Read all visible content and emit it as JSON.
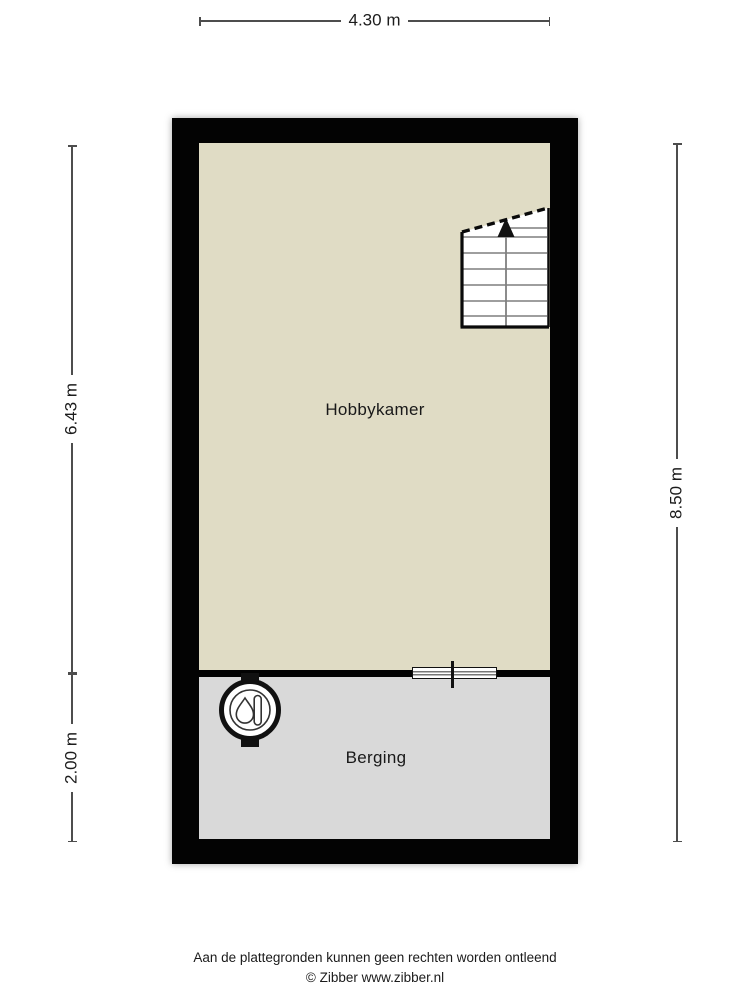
{
  "plan": {
    "dimensions": {
      "width_top": "4.30 m",
      "height_left_upper": "6.43 m",
      "height_left_lower": "2.00 m",
      "height_right": "8.50 m"
    },
    "rooms": [
      {
        "name": "Hobbykamer",
        "floor_color": "#e0dcc5"
      },
      {
        "name": "Berging",
        "floor_color": "#d9d9d9"
      }
    ],
    "fixtures": [
      {
        "name": "staircase",
        "direction": "up"
      },
      {
        "name": "boiler"
      },
      {
        "name": "window-in-inner-wall"
      }
    ],
    "colors": {
      "wall": "#030303",
      "dimension_line": "#4d4d4d",
      "stair_step_line": "#7f7f7f"
    }
  },
  "footer": {
    "disclaimer": "Aan de plattegronden kunnen geen rechten worden ontleend",
    "copyright": "© Zibber www.zibber.nl"
  }
}
